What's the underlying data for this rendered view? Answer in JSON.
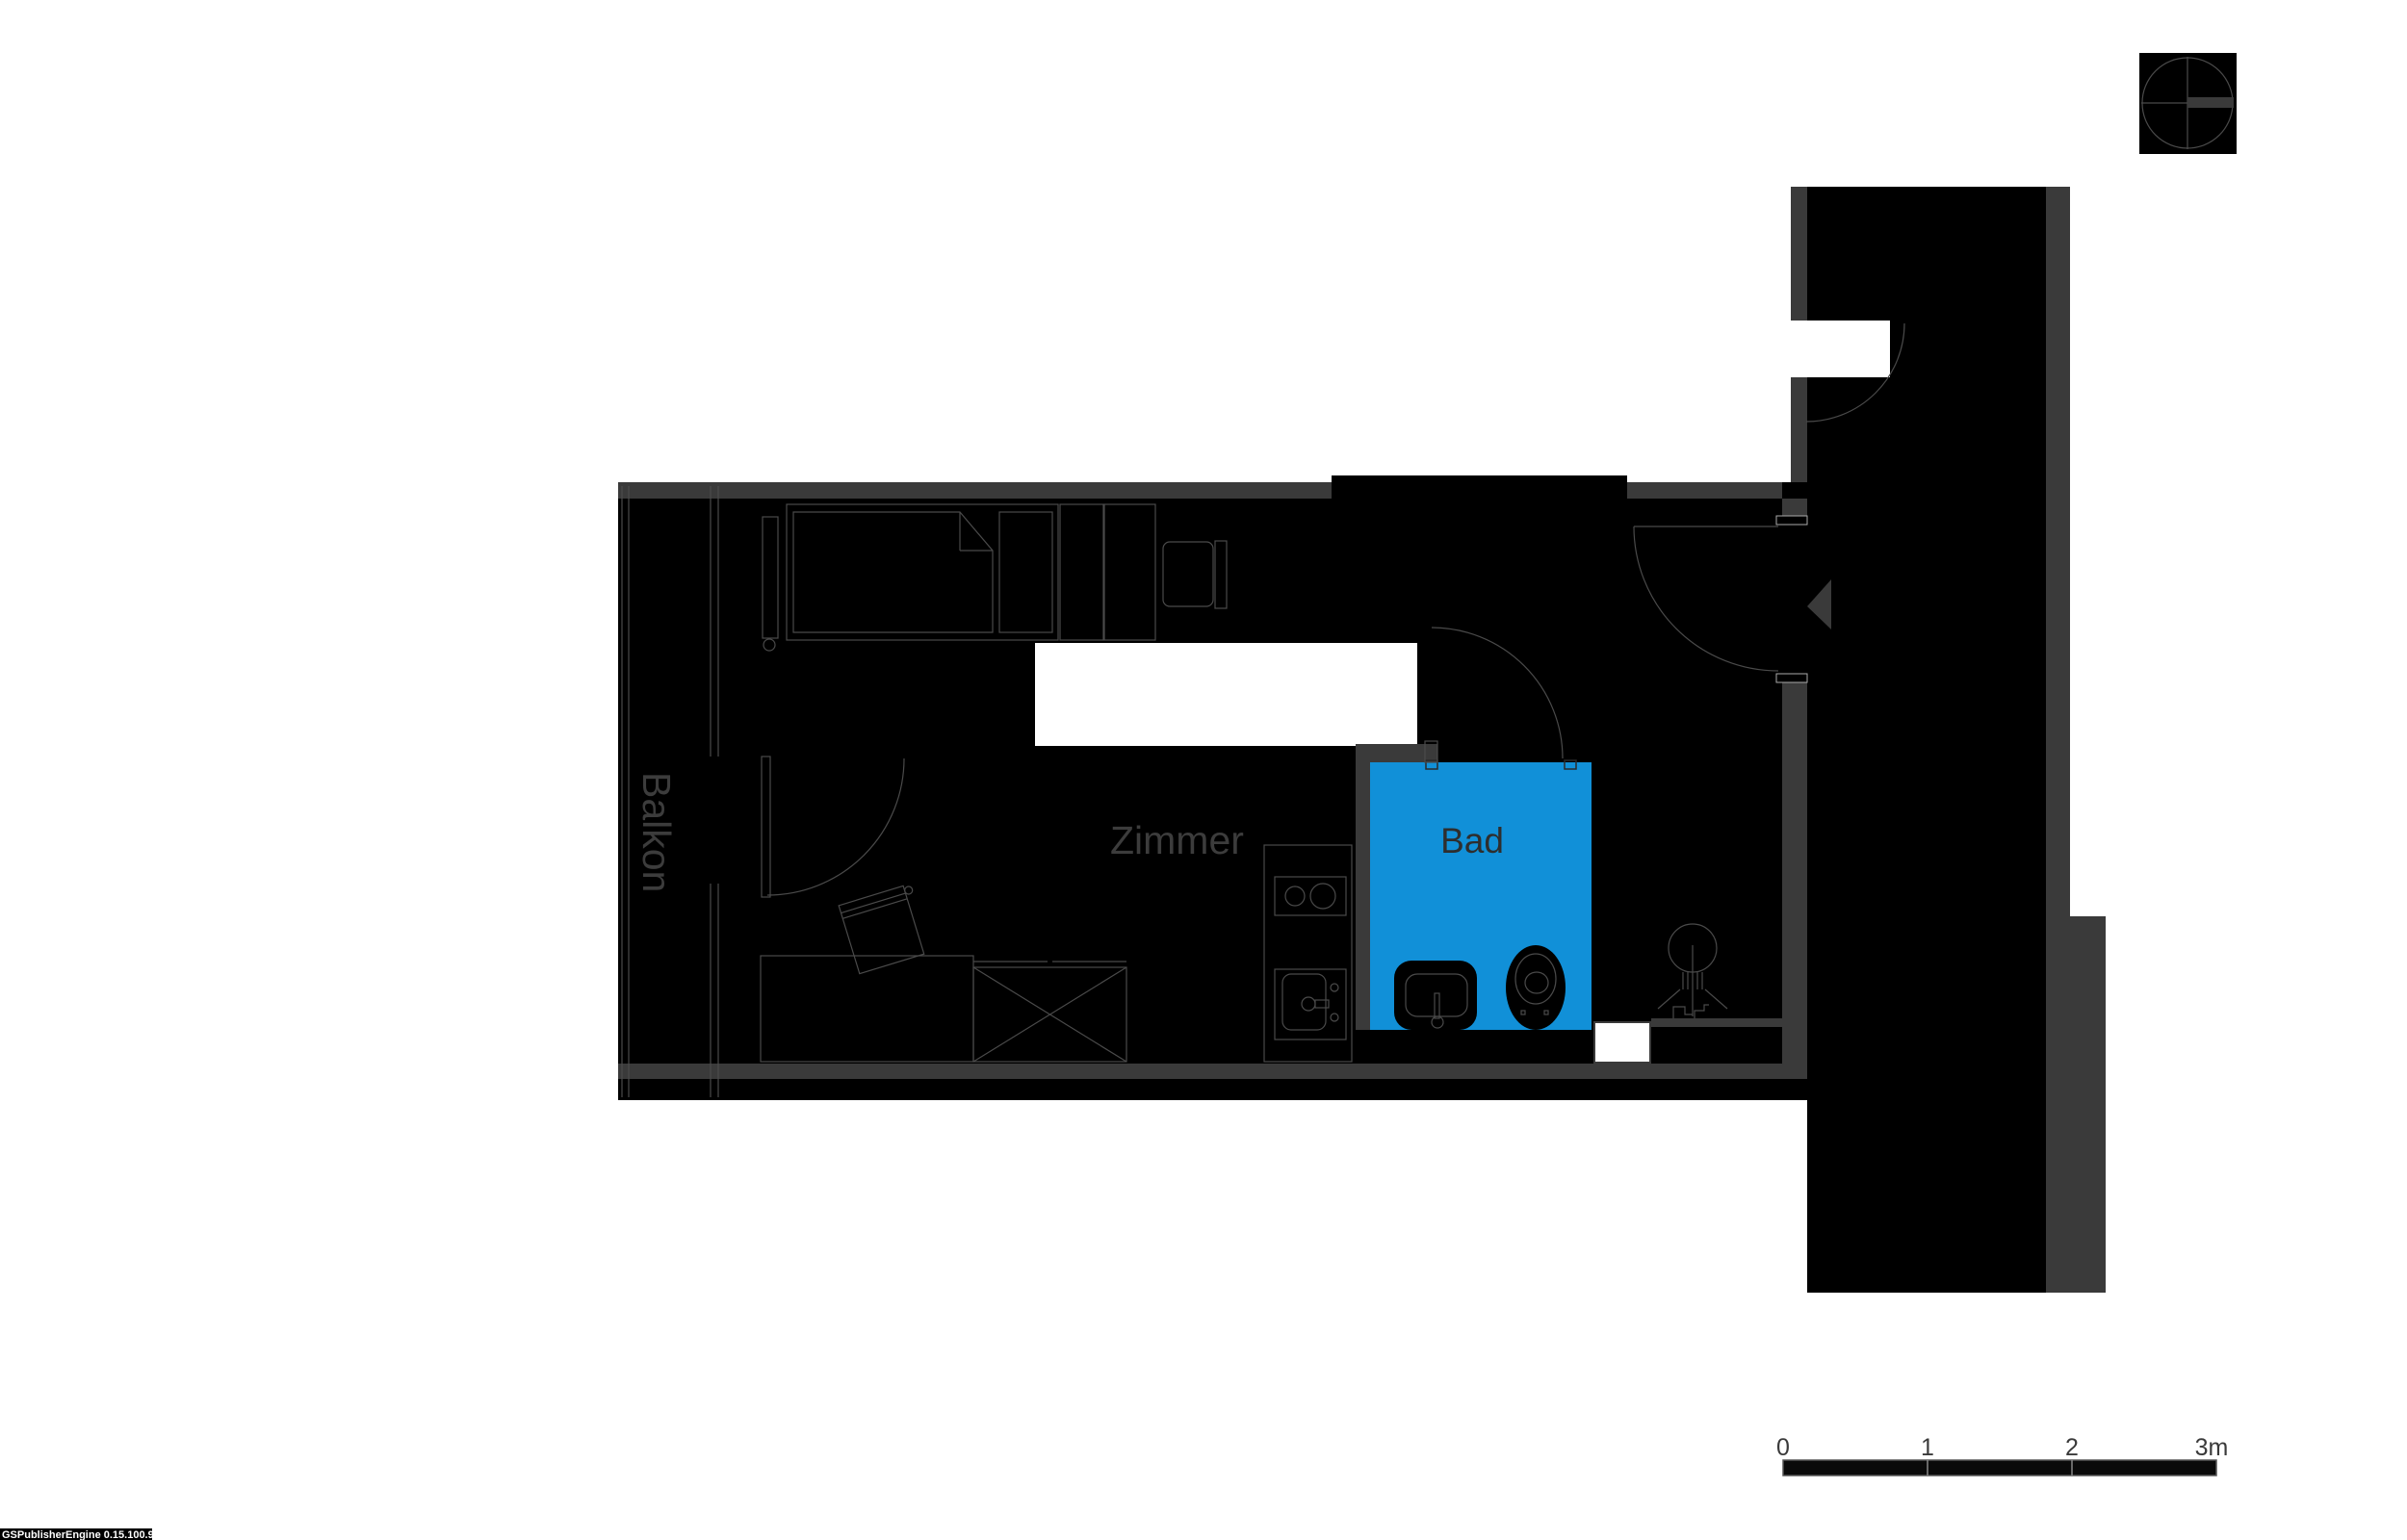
{
  "labels": {
    "balcony": "Balkon",
    "room": "Zimmer",
    "bath": "Bad"
  },
  "scale_bar": {
    "ticks": [
      "0",
      "1",
      "2",
      "3m"
    ]
  },
  "footer": {
    "engine_version": "GSPublisherEngine 0.15.100.99"
  },
  "colors": {
    "bath_fill": "#1190d8",
    "wall_gray": "#3a3a3a",
    "line_gray": "#555555",
    "label_gray": "#3c3c3c",
    "plan_black": "#000000"
  },
  "icons": {
    "compass": "compass-crosshair-icon",
    "entrance_arrow": "entrance-arrow-icon",
    "shower": "shower-icon",
    "toilet": "toilet-icon",
    "washbasin": "washbasin-icon",
    "kitchen_sink": "kitchen-sink-icon",
    "cooktop": "cooktop-icon",
    "bed": "bed-icon",
    "desk_chair": "desk-chair-icon",
    "radiator": "radiator-icon"
  }
}
